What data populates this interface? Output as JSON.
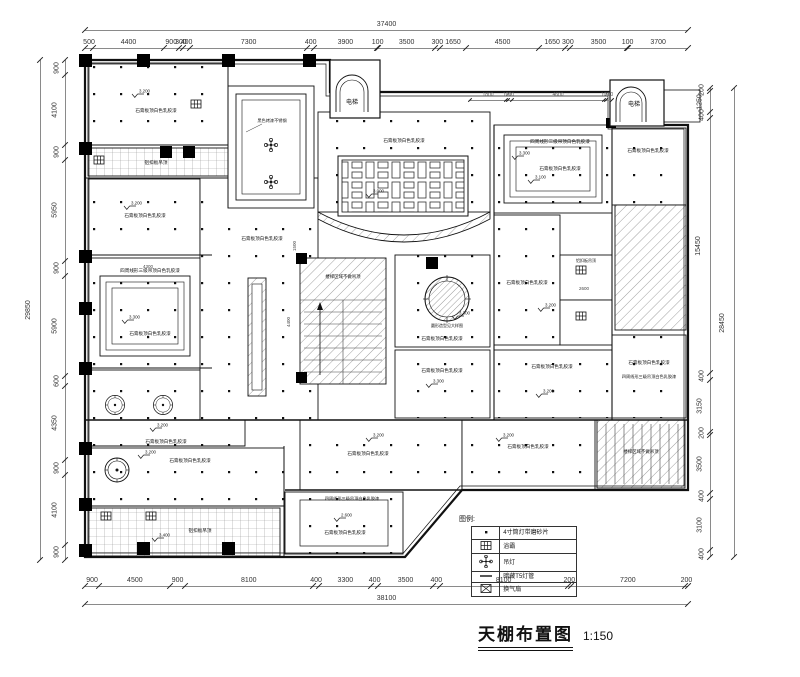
{
  "title": {
    "name": "天棚布置图",
    "scale": "1:150"
  },
  "legend": {
    "header": "图例:",
    "rows": [
      {
        "symbol": "downlight-dot",
        "label": "4寸筒灯带磨砂片"
      },
      {
        "symbol": "bath-heater",
        "label": "浴霸"
      },
      {
        "symbol": "pendant-lamp",
        "label": "吊灯"
      },
      {
        "symbol": "t5-tube",
        "label": "暗藏T5灯管"
      },
      {
        "symbol": "exhaust-fan",
        "label": "换气扇"
      }
    ]
  },
  "labels": {
    "elevator": "电梯",
    "gypsum": "石膏板顶白色乳胶漆",
    "three_level": "四周线形三级吊顶白色乳胶漆",
    "black_steel": "黑色烤漆不锈钢",
    "aluminum": "铝扣板吊顶",
    "stair": "楼梯区域不做吊顶",
    "circle_feature": "圆形造型见大样图"
  },
  "elevations": {
    "a": "3.200",
    "b": "3.300",
    "c": "3.400",
    "d": "3.100",
    "e": "2.600",
    "f": "3.000"
  },
  "dims": {
    "top_total": {
      "segments": [
        37400
      ]
    },
    "top": {
      "segments": [
        500,
        4400,
        900,
        300,
        400,
        7300,
        400,
        3900,
        100,
        3500,
        300,
        1650,
        4500,
        1650,
        300,
        3500,
        100,
        3700
      ]
    },
    "bottom": {
      "segments": [
        900,
        4500,
        900,
        8100,
        400,
        3300,
        400,
        3500,
        400,
        8100,
        200,
        7200,
        200
      ]
    },
    "bottom_total": {
      "segments": [
        38100
      ]
    },
    "left": {
      "segments": [
        900,
        4100,
        900,
        5950,
        900,
        5900,
        600,
        4350,
        900,
        4100,
        900
      ]
    },
    "left_total": {
      "segments": [
        29850
      ]
    },
    "right": {
      "segments": [
        200,
        1250,
        400,
        15450,
        400,
        3150,
        200,
        3500,
        400,
        3100,
        400
      ]
    },
    "right_total": {
      "segments": [
        28450
      ]
    },
    "sub_top_right": {
      "segments": [
        1800,
        100,
        200,
        4600,
        100,
        300
      ]
    },
    "inner": {
      "d1": "4400",
      "d2": "1500",
      "d3": "2600",
      "d4": "4300"
    }
  }
}
